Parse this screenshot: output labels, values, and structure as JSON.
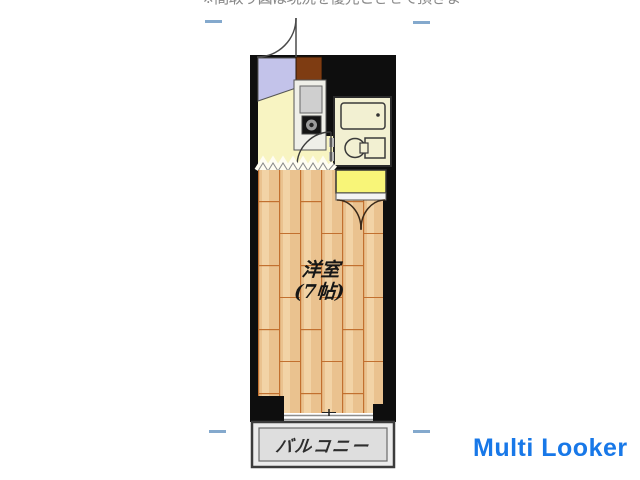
{
  "page": {
    "background": "#ffffff",
    "top_clipped_text": "※間取り図は現況を優先とさせて頂きます"
  },
  "floor_plan": {
    "type": "apartment-floorplan",
    "room_label": {
      "line1": "洋室",
      "line2": "(7帖)"
    },
    "balcony_label": "バルコニー",
    "rooms": [
      {
        "name": "entrance-genkan",
        "color": "#c3c3ea"
      },
      {
        "name": "kitchen",
        "color": "#f8f4c2"
      },
      {
        "name": "unit-bath-toilet",
        "color": "#f2f0d2"
      },
      {
        "name": "western-room-7jo",
        "color": "#eac28f"
      },
      {
        "name": "closet",
        "color": "#f8f578"
      },
      {
        "name": "balcony",
        "color": "#dedede"
      }
    ],
    "fixtures": [
      "entrance-door-arc",
      "kitchen-counter",
      "sink",
      "stove",
      "bathtub",
      "toilet",
      "bathroom-door-arc",
      "closet-double-doors",
      "sliding-window",
      "wall-pillar"
    ],
    "colors": {
      "wall": "#0e0e0e",
      "wood_floor": "#eac28f",
      "plank_line": "#c2702f",
      "counter_brown": "#7e3c12",
      "marker_blue": "#84a9cd"
    }
  },
  "watermark": {
    "text": "Multi Looker",
    "color": "#1878e8"
  }
}
